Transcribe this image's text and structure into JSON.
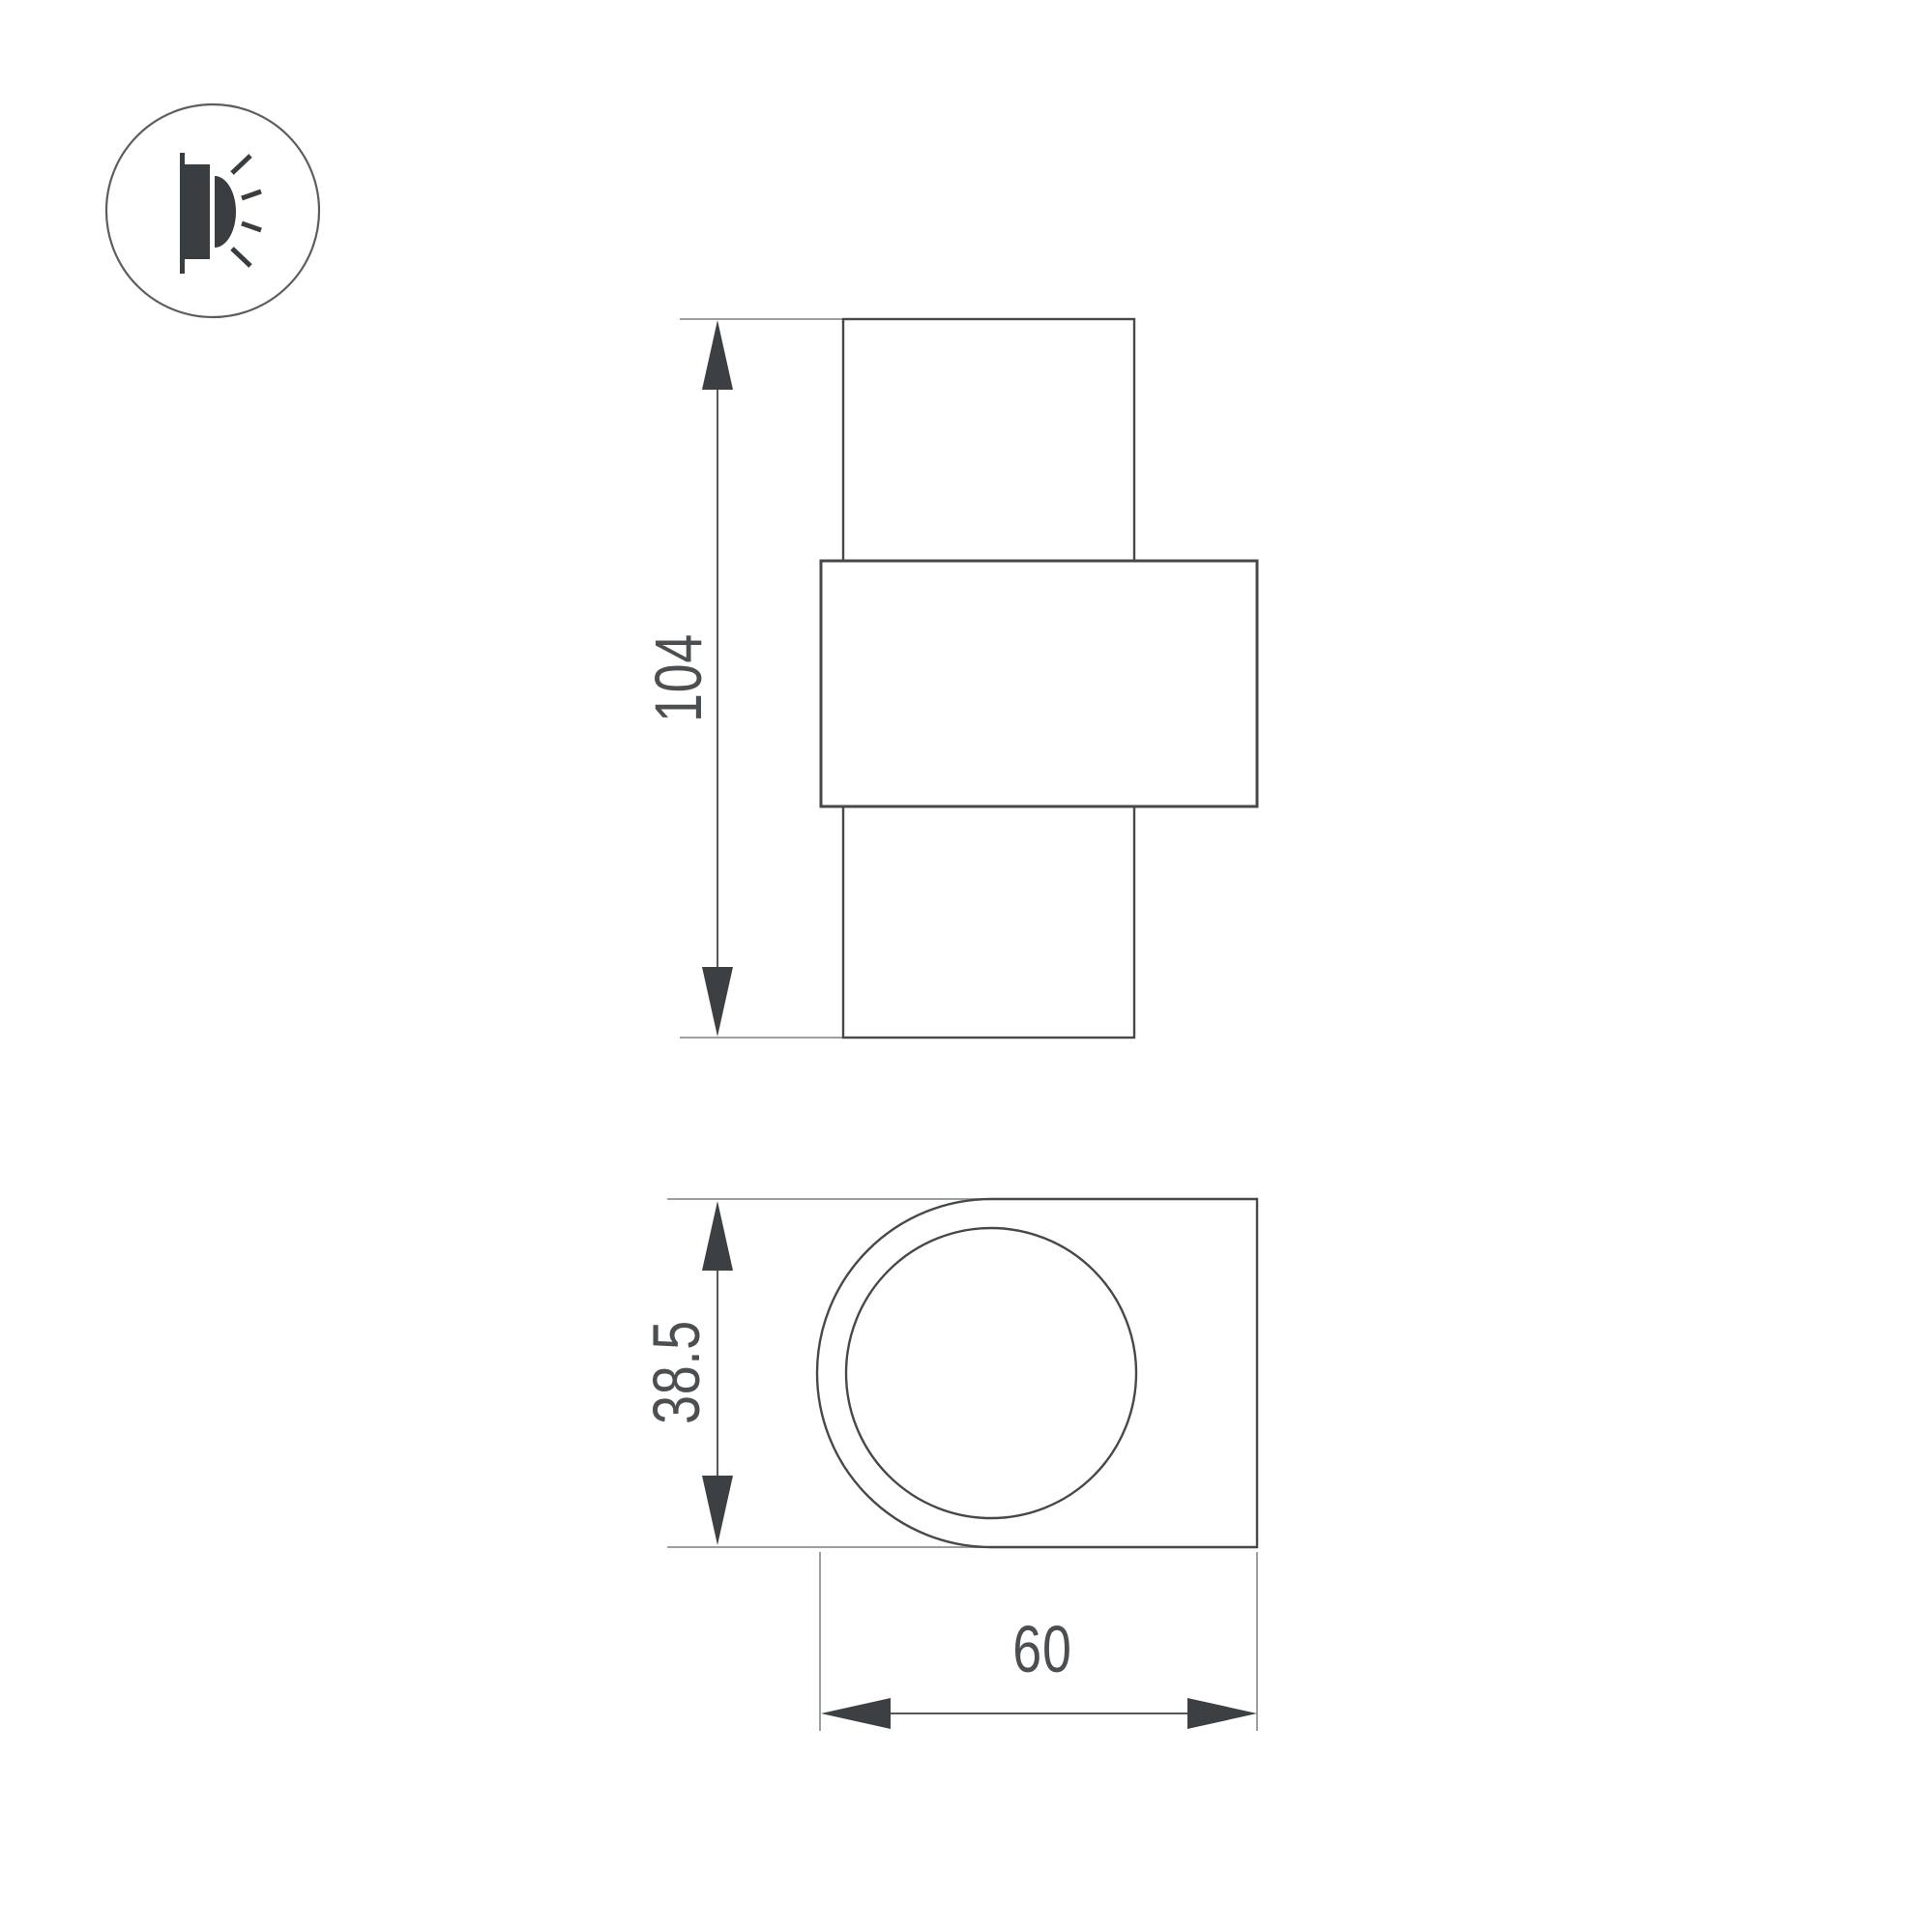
{
  "drawing": {
    "kind": "technical dimension drawing",
    "product": "wall-mounted luminaire",
    "views": {
      "front": "front view with overall height dimension",
      "bottom": "bottom view with depth and width dimensions"
    }
  },
  "icon": {
    "name": "wall-light-icon",
    "description": "wall lamp emitting light rays sideways",
    "ray_count": 4
  },
  "dimensions": {
    "height": {
      "value": "104",
      "orientation": "vertical"
    },
    "depth": {
      "value": "38.5",
      "orientation": "vertical"
    },
    "width": {
      "value": "60",
      "orientation": "horizontal"
    }
  },
  "colors": {
    "background": "#ffffff",
    "shape-line": "#46494c",
    "dim-line": "#55585b",
    "ext-line": "#9ba0a3",
    "arrow-fill": "#3d4043",
    "icon-fill": "#3a3d40",
    "icon-stroke": "#5b5e61",
    "text": "#4c4f52"
  }
}
